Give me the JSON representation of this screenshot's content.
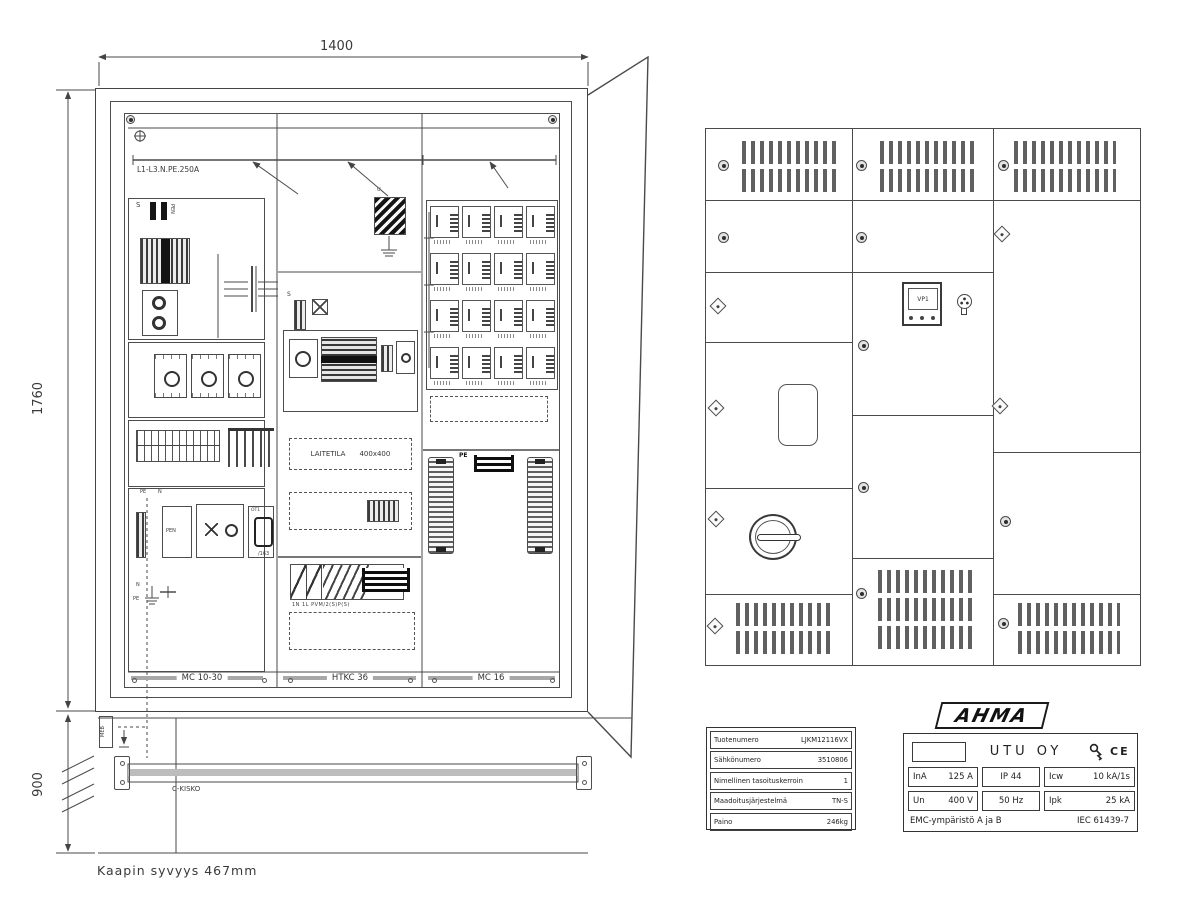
{
  "left_view": {
    "dim_width": "1400",
    "dim_height": "1760",
    "dim_base": "900",
    "busbar_label": "L1-L3.N.PE.250A",
    "s_mark": "S",
    "u_mark": "U",
    "pen_label": "PEN",
    "pe_mark": "PE",
    "n_mark": "N",
    "ot1_label": "OT1",
    "dev163_label": "/163",
    "laitetila_label": "LAITETILA",
    "laitetila_size": "400x400",
    "breaker_row_label": "1N 1L PVM/2(S)P(S)",
    "columns": [
      "MC 10-30",
      "HTKC 36",
      "MC 16"
    ],
    "meb_label": "MEB",
    "c_rail_label": "C-KISKO",
    "depth_note": "Kaapin syvyys 467mm"
  },
  "door_view": {
    "meter_label": "VP1"
  },
  "info_table": {
    "rows": [
      {
        "label": "Tuotenumero",
        "value": "LJKM12116VX"
      },
      {
        "label": "Sähkönumero",
        "value": "3510806"
      },
      {
        "label": "Nimellinen tasoituskerroin",
        "value": "1"
      },
      {
        "label": "Maadoitusjärjestelmä",
        "value": "TN-S"
      },
      {
        "label": "Paino",
        "value": "246kg"
      }
    ]
  },
  "nameplate": {
    "brand": "AHMA",
    "company": "UTU OY",
    "ce_mark": "CE",
    "row1": [
      {
        "label": "InA",
        "value": "125 A"
      },
      {
        "label": "IP 44",
        "value": ""
      },
      {
        "label": "Icw",
        "value": "10 kA/1s"
      }
    ],
    "row2": [
      {
        "label": "Un",
        "value": "400 V"
      },
      {
        "label": "50 Hz",
        "value": ""
      },
      {
        "label": "Ipk",
        "value": "25 kA"
      }
    ],
    "footer_left": "EMC-ympäristö  A ja B",
    "footer_right": "IEC 61439-7"
  }
}
